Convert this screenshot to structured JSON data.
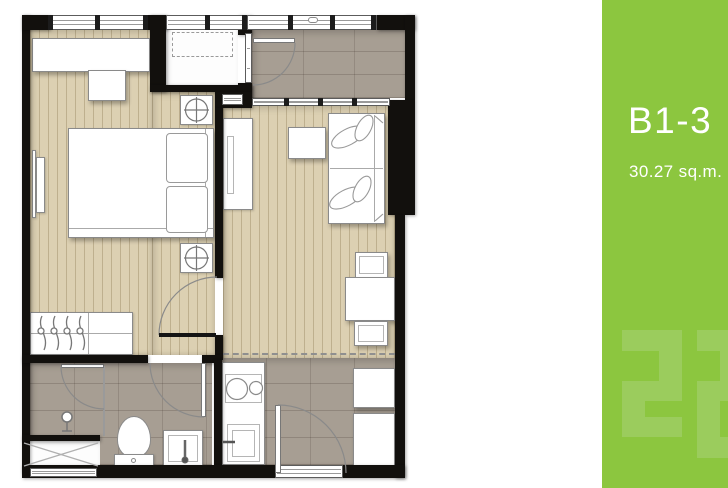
{
  "sidebar": {
    "unit_label": "B1-3",
    "area_label": "30.27 sq.m.",
    "watermark_text": "22",
    "bg_color": "#8cc63f",
    "watermark_color": "#9bcc5d",
    "text_color": "#ffffff"
  },
  "floorplan": {
    "colors": {
      "wall": "#12100d",
      "wood_floor": "#dcd0b2",
      "tile_floor": "#a79e93",
      "fixture_outline": "#8a8a8a"
    },
    "icons": {
      "ceiling-light-icon": "circle-with-cross-in-square",
      "hanger-icon": "curved-clothes-hook-with-ring",
      "shower-head-icon": "circle-on-stem",
      "ac-condenser-outline": "dashed-rectangle",
      "void-shaft": "rectangle-with-x-cross"
    }
  }
}
